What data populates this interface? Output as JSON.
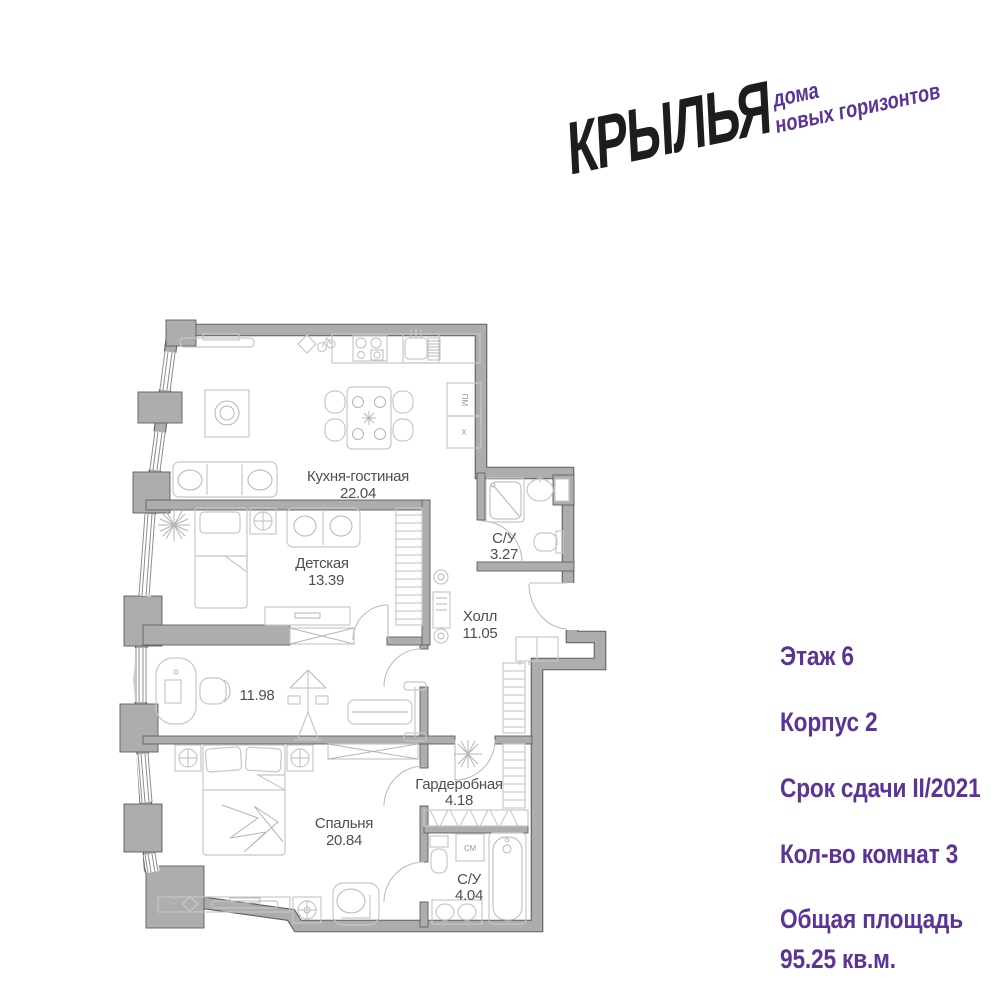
{
  "logo": {
    "brand": "КРЫЛЬЯ",
    "tagline_line1": "дома",
    "tagline_line2": "новых горизонтов"
  },
  "info": {
    "floor": "Этаж 6",
    "building": "Корпус 2",
    "deadline": "Срок сдачи II/2021",
    "rooms_count": "Кол-во комнат 3",
    "total_area_label": "Общая площадь",
    "total_area_value": "95.25 кв.м."
  },
  "colors": {
    "brand_purple": "#5c3496",
    "logo_black": "#1d1d1d",
    "wall_gray": "#adadad",
    "wall_outline": "#5f5f5f",
    "furniture_gray": "#c7c7c7",
    "label_gray": "#4f4f4f"
  },
  "floorplan": {
    "rooms": [
      {
        "name": "Кухня-гостиная",
        "area": "22.04"
      },
      {
        "name": "Детская",
        "area": "13.39"
      },
      {
        "name": "С/У",
        "area": "3.27"
      },
      {
        "name": "Холл",
        "area": "11.05"
      },
      {
        "name": "",
        "area": "11.98"
      },
      {
        "name": "Гардеробная",
        "area": "4.18"
      },
      {
        "name": "Спальня",
        "area": "20.84"
      },
      {
        "name": "С/У",
        "area": "4.04"
      }
    ],
    "appliance_labels": {
      "dishwasher": "ПМ",
      "fridge": "X",
      "washer": "СМ"
    }
  }
}
